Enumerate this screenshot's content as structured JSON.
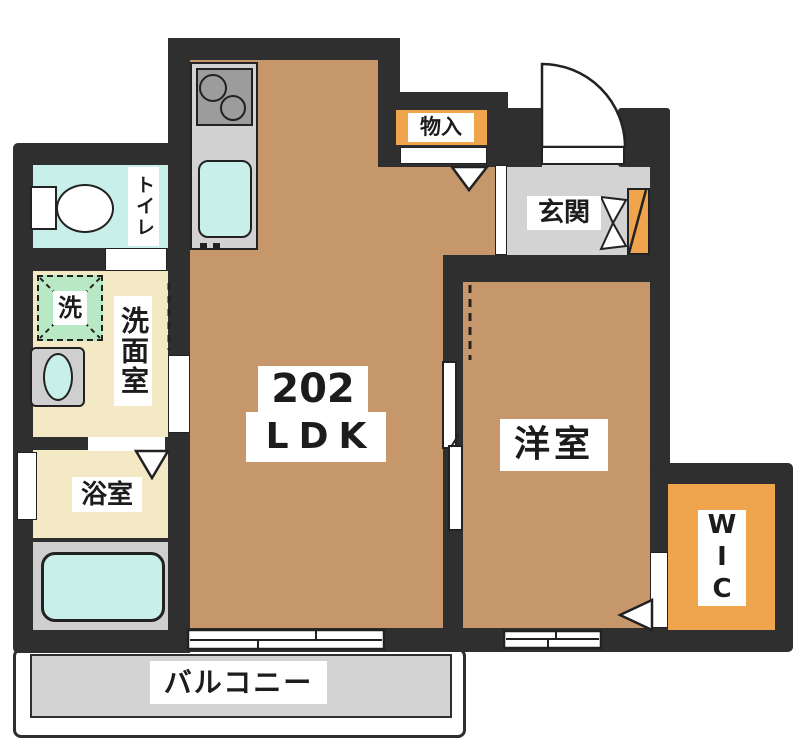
{
  "plan_title": "floor-plan",
  "labels": {
    "unit_number": "202",
    "unit_type": "LDK",
    "storage": "物入",
    "entrance": "玄関",
    "western_room": "洋室",
    "wic": "WIC",
    "toilet": "トイレ",
    "washer": "洗",
    "washroom": "洗面室",
    "bathroom": "浴室",
    "balcony": "バルコニー"
  },
  "colors": {
    "wall": "#2f2f2f",
    "floor_wood": "#c6976a",
    "accent_orange": "#efa44e",
    "cream": "#f3e9c5",
    "water_cyan": "#c8efe9",
    "washer_green": "#b9e8c4",
    "gray_floor": "#d3d3d3",
    "stove_gray": "#9c9c9c"
  }
}
